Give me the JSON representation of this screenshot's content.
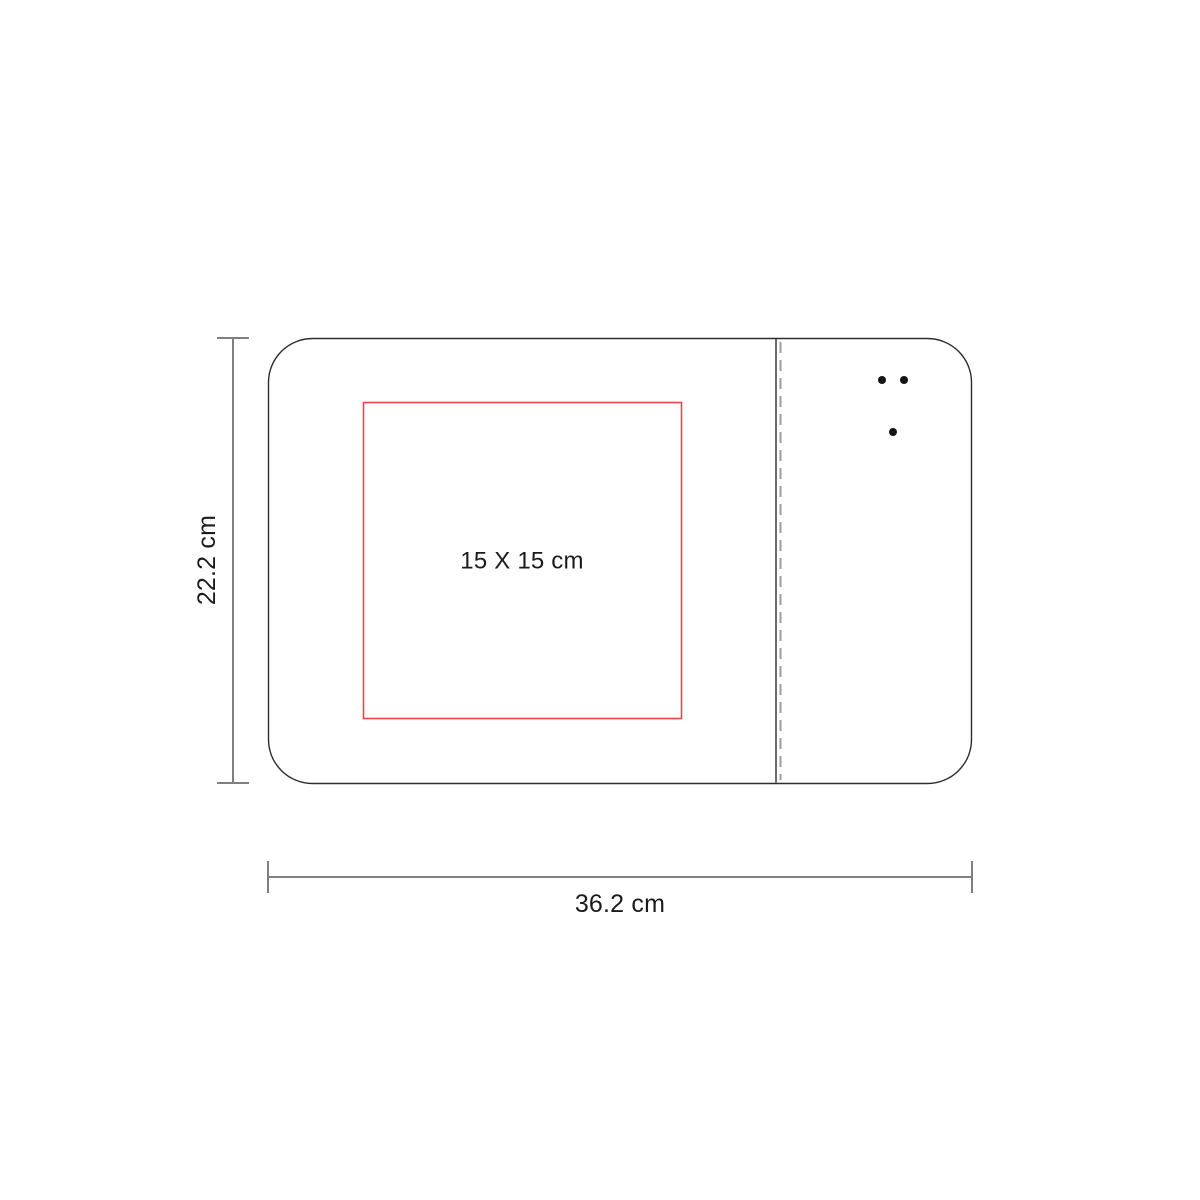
{
  "diagram": {
    "labels": {
      "height": "22.2 cm",
      "width": "36.2 cm",
      "print_area": "15 X 15 cm"
    },
    "colors": {
      "outline": "#2d2d2d",
      "divider": "#3a3a3a",
      "stitching": "#9d9d9d",
      "dots": "#151515",
      "print_area": "#ef4146",
      "dimension_lines": "#7f7f7f",
      "text": "#1b1b1b"
    },
    "dots_count": 3
  }
}
